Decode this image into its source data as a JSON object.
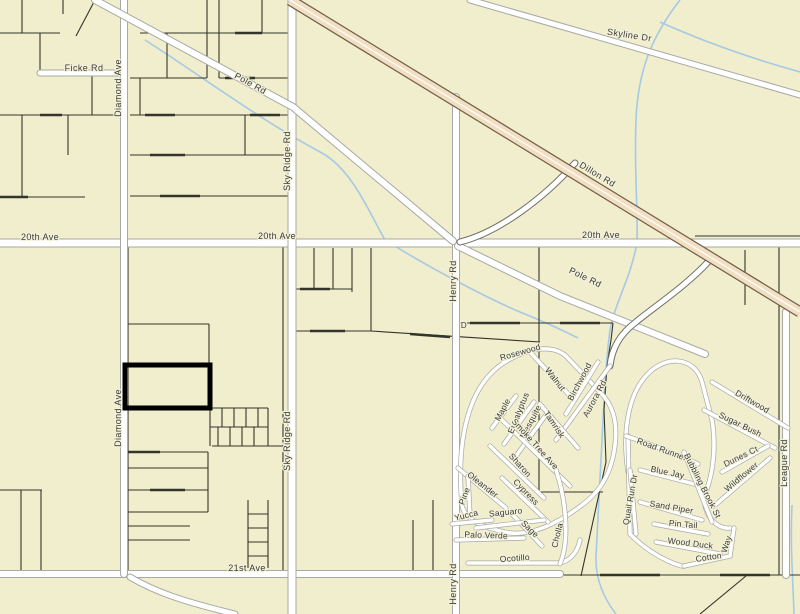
{
  "map": {
    "width": 800,
    "height": 614,
    "colors": {
      "background": "#f0eecd",
      "parcel_line": "#35342a",
      "road_fill": "#ffffff",
      "road_casing": "#a8a8a4",
      "ramp_casing": "#6f6f6b",
      "highway_fill": "#f2dfc2",
      "highway_casing": "#6e5b48",
      "highway_centerline": "#fcfbf6",
      "water": "#a6c9e4",
      "label": "#3a3a38",
      "highlight": "#000000"
    },
    "highlight_parcel": {
      "x": 125,
      "y": 365,
      "w": 85,
      "h": 43,
      "stroke_width": 5
    },
    "parcel_lines": [
      [
        0,
        115,
        119,
        115
      ],
      [
        0,
        197,
        85,
        197
      ],
      [
        22,
        115,
        22,
        197
      ],
      [
        40,
        33,
        40,
        74
      ],
      [
        92,
        74,
        92,
        115
      ],
      [
        68,
        115,
        68,
        155
      ],
      [
        0,
        33,
        60,
        33
      ],
      [
        22,
        0,
        22,
        33
      ],
      [
        63,
        0,
        63,
        14
      ],
      [
        95,
        0,
        76,
        36
      ],
      [
        140,
        33,
        288,
        33
      ],
      [
        130,
        78,
        207,
        78
      ],
      [
        219,
        78,
        288,
        78
      ],
      [
        130,
        115,
        288,
        115
      ],
      [
        130,
        155,
        288,
        155
      ],
      [
        130,
        196,
        288,
        196
      ],
      [
        207,
        0,
        207,
        78
      ],
      [
        219,
        0,
        219,
        78
      ],
      [
        167,
        33,
        167,
        78
      ],
      [
        140,
        78,
        140,
        115
      ],
      [
        262,
        0,
        262,
        33
      ],
      [
        245,
        115,
        245,
        155
      ],
      [
        0,
        490,
        42,
        490
      ],
      [
        21,
        490,
        21,
        571
      ],
      [
        41,
        490,
        41,
        571
      ],
      [
        128,
        243,
        128,
        574
      ],
      [
        283,
        243,
        283,
        574
      ],
      [
        128,
        324,
        209,
        324
      ],
      [
        209,
        324,
        209,
        366
      ],
      [
        128,
        452,
        208,
        452
      ],
      [
        128,
        468,
        208,
        468
      ],
      [
        128,
        490,
        208,
        490
      ],
      [
        128,
        512,
        208,
        512
      ],
      [
        128,
        526,
        190,
        526
      ],
      [
        128,
        540,
        190,
        540
      ],
      [
        208,
        452,
        208,
        512
      ],
      [
        210,
        366,
        210,
        446
      ],
      [
        210,
        408,
        268,
        408
      ],
      [
        210,
        427,
        268,
        427
      ],
      [
        212,
        446,
        290,
        446
      ],
      [
        222,
        408,
        222,
        427
      ],
      [
        234,
        408,
        234,
        427
      ],
      [
        246,
        408,
        246,
        427
      ],
      [
        258,
        408,
        258,
        427
      ],
      [
        268,
        408,
        268,
        446
      ],
      [
        218,
        427,
        218,
        446
      ],
      [
        230,
        427,
        230,
        446
      ],
      [
        242,
        427,
        242,
        446
      ],
      [
        254,
        427,
        254,
        446
      ],
      [
        248,
        500,
        248,
        568
      ],
      [
        268,
        500,
        268,
        568
      ],
      [
        248,
        514,
        268,
        514
      ],
      [
        248,
        528,
        268,
        528
      ],
      [
        248,
        542,
        268,
        542
      ],
      [
        248,
        556,
        268,
        556
      ],
      [
        314,
        248,
        314,
        289
      ],
      [
        333,
        248,
        333,
        289
      ],
      [
        352,
        248,
        352,
        292
      ],
      [
        371,
        248,
        371,
        331
      ],
      [
        296,
        289,
        352,
        289
      ],
      [
        296,
        331,
        371,
        331
      ],
      [
        371,
        331,
        540,
        342
      ],
      [
        433,
        500,
        433,
        574
      ],
      [
        413,
        520,
        413,
        574
      ],
      [
        455,
        323,
        613,
        323
      ],
      [
        613,
        323,
        611,
        340
      ],
      [
        611,
        340,
        607,
        366
      ],
      [
        607,
        366,
        604,
        410
      ],
      [
        604,
        410,
        606,
        462
      ],
      [
        606,
        462,
        581,
        576
      ],
      [
        539,
        245,
        539,
        492
      ],
      [
        539,
        492,
        603,
        492
      ],
      [
        779,
        245,
        779,
        575
      ],
      [
        745,
        250,
        745,
        305
      ],
      [
        695,
        236,
        800,
        236
      ],
      [
        560,
        575,
        800,
        575
      ],
      [
        700,
        614,
        746,
        576
      ]
    ],
    "survey_ticks": [
      [
        145,
        115,
        175,
        115
      ],
      [
        225,
        78,
        255,
        78
      ],
      [
        0,
        197,
        28,
        197
      ],
      [
        150,
        155,
        185,
        155
      ],
      [
        235,
        33,
        262,
        33
      ],
      [
        160,
        196,
        200,
        196
      ],
      [
        40,
        115,
        62,
        115
      ],
      [
        250,
        115,
        280,
        115
      ],
      [
        300,
        289,
        330,
        289
      ],
      [
        310,
        331,
        345,
        331
      ],
      [
        470,
        323,
        520,
        323
      ],
      [
        560,
        323,
        600,
        323
      ],
      [
        128,
        452,
        160,
        452
      ],
      [
        150,
        490,
        185,
        490
      ],
      [
        600,
        575,
        660,
        575
      ],
      [
        720,
        575,
        770,
        575
      ],
      [
        410,
        334,
        450,
        337
      ],
      [
        255,
        574,
        300,
        574
      ]
    ],
    "roads": [
      {
        "name": "20th-ave",
        "path": "M0,243 L800,243",
        "w": 7,
        "cls": "road"
      },
      {
        "name": "21st-ave",
        "path": "M0,574 L560,574",
        "w": 6,
        "cls": "road"
      },
      {
        "name": "ficke-rd",
        "path": "M40,73 L124,73",
        "w": 5,
        "cls": "road"
      },
      {
        "name": "diamond-ave",
        "path": "M124,0 L124,574",
        "w": 6,
        "cls": "road"
      },
      {
        "name": "diamond-ave-spur",
        "path": "M130,577 C155,592 185,602 235,614",
        "w": 5,
        "cls": "road"
      },
      {
        "name": "sky-ridge-rd",
        "path": "M292,0 L292,614",
        "w": 7,
        "cls": "road"
      },
      {
        "name": "henry-rd",
        "path": "M456,97 L456,614",
        "w": 6,
        "cls": "road"
      },
      {
        "name": "league-rd",
        "path": "M786,312 L786,575",
        "w": 6,
        "cls": "road"
      },
      {
        "name": "pole-rd-west",
        "path": "M95,0 L293,107 L453,241",
        "w": 6,
        "cls": "road"
      },
      {
        "name": "pole-rd-east",
        "path": "M458,246 L560,296 L705,354",
        "w": 6,
        "cls": "road"
      },
      {
        "name": "skyline-dr",
        "path": "M470,0 L800,95",
        "w": 5,
        "cls": "road"
      },
      {
        "name": "dillon-ramp",
        "path": "M575,163 C546,196 500,232 460,242",
        "w": 5,
        "cls": "ramp"
      },
      {
        "name": "aurora-connector",
        "path": "M708,262 C686,286 650,310 636,322 C620,334 612,348 610,366",
        "w": 5,
        "cls": "ramp"
      }
    ],
    "streets": [
      {
        "name": "rosewood-loop",
        "path": "M462,505 C456,440 468,385 505,362 C528,348 552,344 566,356 L600,392 C612,404 618,420 615,445 C612,472 600,492 582,505 C560,522 530,538 505,532 C480,527 464,518 462,505"
      },
      {
        "name": "ocotillo-st",
        "path": "M468,563 L560,563 C572,560 578,550 580,540"
      },
      {
        "name": "walnut-st",
        "path": "M530,352 L572,398"
      },
      {
        "name": "birchwood-st",
        "path": "M566,414 L598,362"
      },
      {
        "name": "aurora-rd-st",
        "path": "M610,366 L556,440"
      },
      {
        "name": "maple-st",
        "path": "M492,428 L516,396"
      },
      {
        "name": "eucalyptus-st",
        "path": "M504,444 L534,402"
      },
      {
        "name": "mesquite-st",
        "path": "M516,456 L548,412"
      },
      {
        "name": "tamrisk-st",
        "path": "M540,404 L578,448"
      },
      {
        "name": "smoke-tree-ave-st",
        "path": "M498,416 L570,486"
      },
      {
        "name": "sharon-st",
        "path": "M490,446 L544,498"
      },
      {
        "name": "cypress-st",
        "path": "M502,478 L548,522"
      },
      {
        "name": "sage-st",
        "path": "M512,514 L542,546"
      },
      {
        "name": "oleander-st",
        "path": "M458,468 L506,508"
      },
      {
        "name": "pine-st",
        "path": "M468,476 L470,516"
      },
      {
        "name": "yucca-st",
        "path": "M452,524 L492,520"
      },
      {
        "name": "saguaro-st",
        "path": "M476,528 L544,520"
      },
      {
        "name": "palo-verde-st",
        "path": "M456,540 L524,538"
      },
      {
        "name": "cholla-st",
        "path": "M560,564 C570,540 566,500 556,470"
      },
      {
        "name": "east-pod-loop",
        "path": "M628,472 C622,430 628,390 652,370 C672,354 696,360 702,382 L712,420 C716,444 714,470 706,492 C700,512 716,530 730,528"
      },
      {
        "name": "east-pod-left",
        "path": "M628,436 L630,534 C655,560 686,568 684,566"
      },
      {
        "name": "driftwood-st",
        "path": "M712,382 L788,428"
      },
      {
        "name": "sugar-bush-st",
        "path": "M704,410 L775,448"
      },
      {
        "name": "dunes-ct-st",
        "path": "M722,472 L768,446"
      },
      {
        "name": "wildflower-st",
        "path": "M714,506 L770,458"
      },
      {
        "name": "road-runner-st",
        "path": "M626,436 C650,444 672,452 698,464"
      },
      {
        "name": "blue-jay-st",
        "path": "M640,470 L694,484"
      },
      {
        "name": "sand-piper-st",
        "path": "M640,502 L702,520"
      },
      {
        "name": "pin-tail-st",
        "path": "M654,524 L708,534"
      },
      {
        "name": "wood-duck-st",
        "path": "M656,542 L720,554"
      },
      {
        "name": "cotton-st",
        "path": "M684,566 L730,556 L734,528"
      },
      {
        "name": "bubbling-brook-st",
        "path": "M684,452 L712,522"
      },
      {
        "name": "quail-run-dr-st",
        "path": "M630,470 L636,534"
      }
    ],
    "highway": {
      "name": "dillon-rd",
      "path": "M290,0 L800,312",
      "w": 9
    },
    "streams": [
      {
        "name": "wash-east",
        "path": "M680,0 C652,36 638,70 636,120 C634,170 638,205 637,243 C630,280 616,300 610,330 C606,360 604,400 602,440 C600,480 598,520 596,556 C595,580 605,600 616,614"
      },
      {
        "name": "wash-pole",
        "path": "M145,40 C200,75 260,120 322,153 C352,170 368,210 385,240 C420,262 480,295 520,312 C545,322 562,330 578,338"
      },
      {
        "name": "wash-ne",
        "path": "M660,22 C700,40 750,58 800,72"
      },
      {
        "name": "wash-se",
        "path": "M792,505 C790,545 793,580 794,614"
      }
    ],
    "labels": [
      {
        "t": "Ficke Rd",
        "x": 84,
        "y": 71,
        "r": 0,
        "s": 9,
        "c": "road"
      },
      {
        "t": "Diamond Ave",
        "x": 121,
        "y": 88,
        "r": -90,
        "s": 9,
        "c": "road"
      },
      {
        "t": "Diamond Ave",
        "x": 121,
        "y": 418,
        "r": -90,
        "s": 9,
        "c": "road"
      },
      {
        "t": "Pole Rd",
        "x": 249,
        "y": 86,
        "r": 29,
        "s": 9,
        "c": "road"
      },
      {
        "t": "Sky Ridge Rd",
        "x": 290,
        "y": 161,
        "r": -90,
        "s": 9,
        "c": "road"
      },
      {
        "t": "Sky Ridge Rd",
        "x": 290,
        "y": 441,
        "r": -90,
        "s": 9,
        "c": "road"
      },
      {
        "t": "20th Ave",
        "x": 40,
        "y": 240,
        "r": 0,
        "s": 9,
        "c": "road"
      },
      {
        "t": "20th Ave",
        "x": 277,
        "y": 239,
        "r": 0,
        "s": 9,
        "c": "road"
      },
      {
        "t": "20th Ave",
        "x": 601,
        "y": 238,
        "r": 0,
        "s": 9,
        "c": "road"
      },
      {
        "t": "21st Ave",
        "x": 247,
        "y": 571,
        "r": 0,
        "s": 9,
        "c": "road"
      },
      {
        "t": "Henry Rd",
        "x": 456,
        "y": 281,
        "r": -90,
        "s": 9,
        "c": "road"
      },
      {
        "t": "Henry Rd",
        "x": 456,
        "y": 584,
        "r": -90,
        "s": 9,
        "c": "road"
      },
      {
        "t": "League Rd",
        "x": 787,
        "y": 463,
        "r": -90,
        "s": 9,
        "c": "road"
      },
      {
        "t": "Skyline Dr",
        "x": 629,
        "y": 38,
        "r": 9,
        "s": 9,
        "c": "road"
      },
      {
        "t": "Dillon Rd",
        "x": 596,
        "y": 177,
        "r": 31,
        "s": 9,
        "c": "road"
      },
      {
        "t": "Pole Rd",
        "x": 584,
        "y": 280,
        "r": 26,
        "s": 9,
        "c": "road"
      },
      {
        "t": "D",
        "x": 464,
        "y": 328,
        "r": 0,
        "s": 8,
        "c": "road"
      },
      {
        "t": "Rosewood",
        "x": 521,
        "y": 355,
        "r": -16,
        "s": 8.5,
        "c": "sub"
      },
      {
        "t": "Walnut",
        "x": 553,
        "y": 381,
        "r": 52,
        "s": 8.5,
        "c": "sub"
      },
      {
        "t": "Birchwood",
        "x": 582,
        "y": 383,
        "r": -62,
        "s": 8.5,
        "c": "sub"
      },
      {
        "t": "Aurora Rd",
        "x": 597,
        "y": 400,
        "r": -62,
        "s": 8.5,
        "c": "sub"
      },
      {
        "t": "Maple",
        "x": 505,
        "y": 411,
        "r": -62,
        "s": 8.5,
        "c": "sub"
      },
      {
        "t": "Eucalyptus",
        "x": 521,
        "y": 414,
        "r": -68,
        "s": 8.5,
        "c": "sub"
      },
      {
        "t": "Mesquite",
        "x": 533,
        "y": 423,
        "r": -62,
        "s": 8.5,
        "c": "sub"
      },
      {
        "t": "Tamrisk",
        "x": 552,
        "y": 426,
        "r": 56,
        "s": 8.5,
        "c": "sub"
      },
      {
        "t": "Smoke Tree Ave",
        "x": 533,
        "y": 446,
        "r": 48,
        "s": 8.5,
        "c": "sub"
      },
      {
        "t": "Sharon",
        "x": 518,
        "y": 467,
        "r": 48,
        "s": 8.5,
        "c": "sub"
      },
      {
        "t": "Cypress",
        "x": 524,
        "y": 494,
        "r": 46,
        "s": 8.5,
        "c": "sub"
      },
      {
        "t": "Oleander",
        "x": 481,
        "y": 487,
        "r": 38,
        "s": 8.5,
        "c": "sub"
      },
      {
        "t": "Pine",
        "x": 467,
        "y": 497,
        "r": -70,
        "s": 8.5,
        "c": "sub"
      },
      {
        "t": "Yucca",
        "x": 467,
        "y": 518,
        "r": -14,
        "s": 8.5,
        "c": "sub"
      },
      {
        "t": "Saguaro",
        "x": 506,
        "y": 515,
        "r": -6,
        "s": 8.5,
        "c": "sub"
      },
      {
        "t": "Sage",
        "x": 528,
        "y": 531,
        "r": 44,
        "s": 8.5,
        "c": "sub"
      },
      {
        "t": "Palo Verde",
        "x": 486,
        "y": 538,
        "r": 2,
        "s": 8.5,
        "c": "sub"
      },
      {
        "t": "Ocotillo",
        "x": 515,
        "y": 561,
        "r": -4,
        "s": 8.5,
        "c": "sub"
      },
      {
        "t": "Cholla",
        "x": 560,
        "y": 536,
        "r": -76,
        "s": 8.5,
        "c": "sub"
      },
      {
        "t": "Road Runner",
        "x": 661,
        "y": 452,
        "r": 20,
        "s": 8.5,
        "c": "sub"
      },
      {
        "t": "Blue Jay",
        "x": 667,
        "y": 475,
        "r": 12,
        "s": 8.5,
        "c": "sub"
      },
      {
        "t": "Quail Run Dr",
        "x": 633,
        "y": 500,
        "r": -80,
        "s": 8.5,
        "c": "sub"
      },
      {
        "t": "Sand Piper",
        "x": 671,
        "y": 510,
        "r": 10,
        "s": 8.5,
        "c": "sub"
      },
      {
        "t": "Pin Tail",
        "x": 683,
        "y": 527,
        "r": 5,
        "s": 8.5,
        "c": "sub"
      },
      {
        "t": "Wood Duck",
        "x": 690,
        "y": 546,
        "r": 7,
        "s": 8.5,
        "c": "sub"
      },
      {
        "t": "Cotton",
        "x": 709,
        "y": 560,
        "r": -8,
        "s": 8.5,
        "c": "sub"
      },
      {
        "t": "Way",
        "x": 729,
        "y": 545,
        "r": -72,
        "s": 8.5,
        "c": "sub"
      },
      {
        "t": "Bubbling Brook St",
        "x": 700,
        "y": 487,
        "r": 63,
        "s": 8.5,
        "c": "sub"
      },
      {
        "t": "Wildflower",
        "x": 743,
        "y": 479,
        "r": -40,
        "s": 8.5,
        "c": "sub"
      },
      {
        "t": "Dunes Ct",
        "x": 742,
        "y": 459,
        "r": -26,
        "s": 8.5,
        "c": "sub"
      },
      {
        "t": "Sugar Bush",
        "x": 739,
        "y": 427,
        "r": 26,
        "s": 8.5,
        "c": "sub"
      },
      {
        "t": "Driftwood",
        "x": 751,
        "y": 404,
        "r": 30,
        "s": 8.5,
        "c": "sub"
      }
    ]
  }
}
